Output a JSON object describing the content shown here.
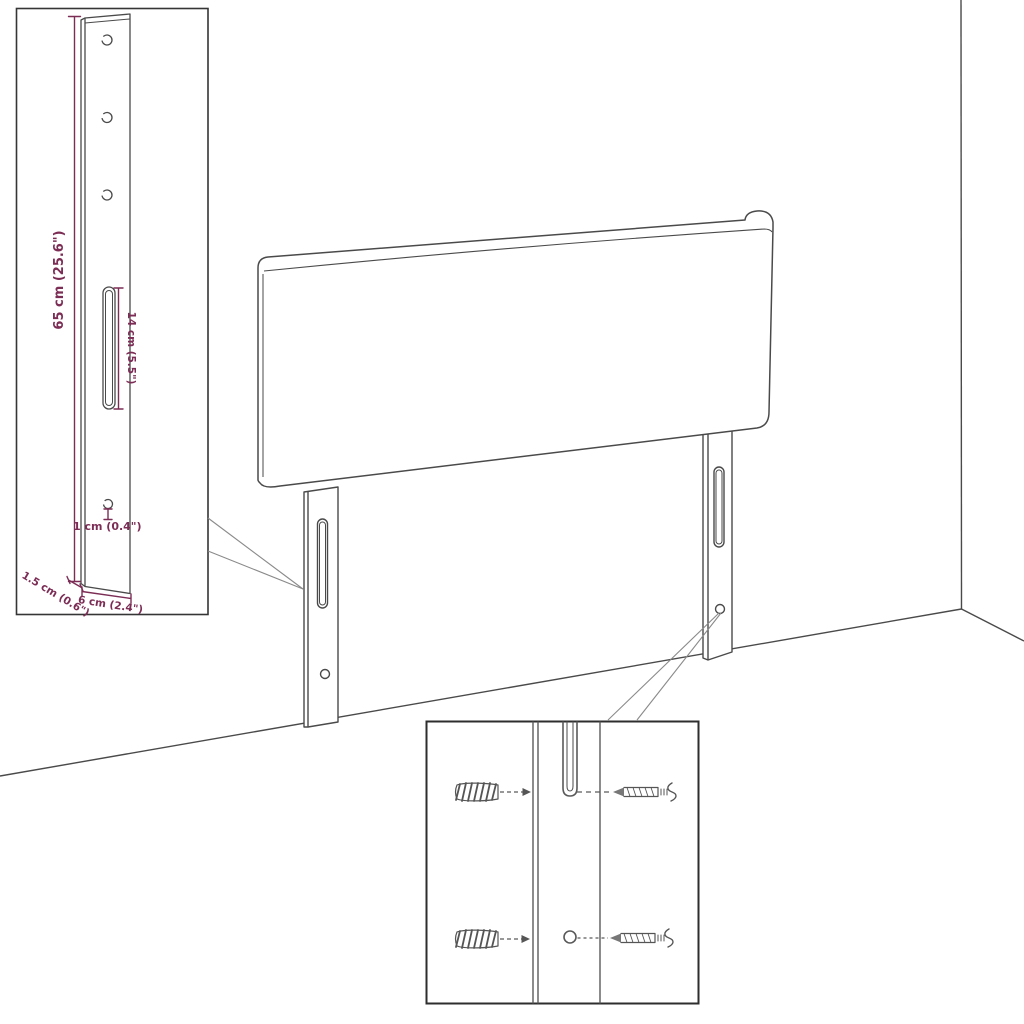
{
  "page": {
    "kind": "product-dimension-diagram",
    "subject": "upholstered headboard with two mounting legs in a room corner"
  },
  "colors": {
    "background": "#ffffff",
    "outline": "#4a4a4a",
    "inset_border": "#353535",
    "detail_line": "#5a5a5a",
    "leader": "#8a8a8a",
    "dimension": "#7C2D55"
  },
  "bracket_inset": {
    "labels": {
      "height": "65 cm (25.6\")",
      "slot": "14 cm (5.5\")",
      "hole": "1 cm (0.4\")",
      "depth": "1.5 cm (0.6\")",
      "width": "6 cm (2.4\")"
    }
  },
  "mounting_inset": {
    "icons": {
      "wall_plug": "wall-plug-icon",
      "screw": "screw-icon",
      "keyhole_slot": "keyhole-slot-icon",
      "screw_hole": "screw-hole-icon"
    }
  }
}
